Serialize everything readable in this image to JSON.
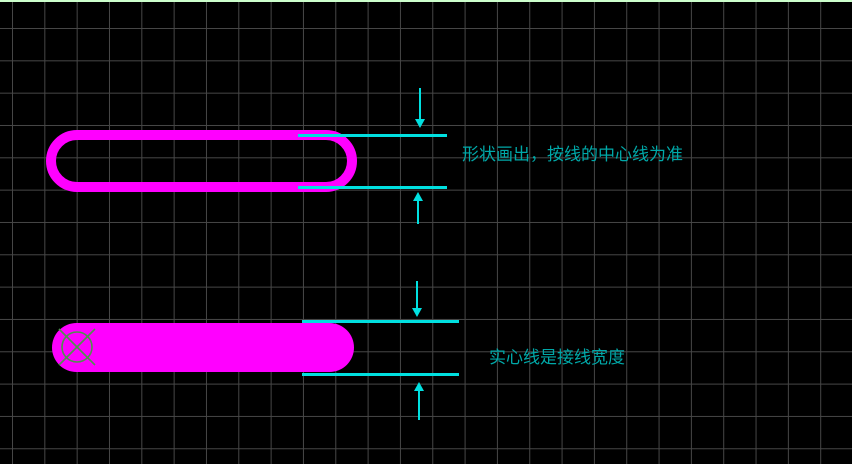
{
  "canvas": {
    "description": "CAD drawing canvas with grid",
    "annotations": {
      "outline_note": "形状画出，按线的中心线为准",
      "solid_note": "实心线是接线宽度"
    },
    "shapes": {
      "outline_pill": "hollow rounded track outline",
      "solid_pill": "solid rounded track"
    },
    "icons": {
      "origin_marker": "circle-cross-origin-icon",
      "dim_arrow_down": "arrow-down-icon",
      "dim_arrow_up": "arrow-up-icon"
    },
    "colors": {
      "canvas-bg": "#000000",
      "grid-line": "#474747",
      "shape-magenta": "#ff00ff",
      "dim-cyan": "#00e0e0",
      "text-teal": "#00a8a8",
      "marker-green": "#4f8f4f",
      "top-edge-green": "#ccffcc"
    }
  }
}
